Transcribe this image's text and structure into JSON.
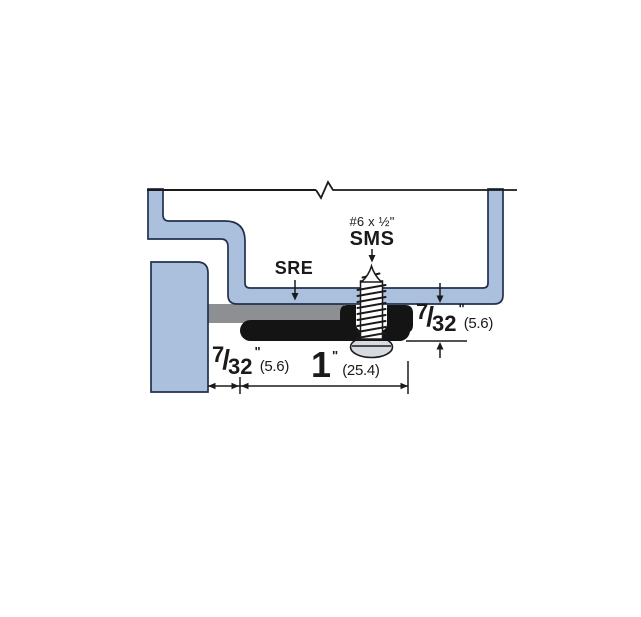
{
  "diagram": {
    "description": "Cross-section installation drawing of SRE door bottom seal fastened with sheet metal screw",
    "labels": {
      "seal": "SRE",
      "screw_size": "#6 x ½\"",
      "screw_type": "SMS"
    },
    "dimensions": {
      "seal_projection": {
        "num": "7",
        "slash": "/",
        "den": "32",
        "unit": "\"",
        "metric": "(5.6)"
      },
      "edge_gap": {
        "num": "7",
        "slash": "/",
        "den": "32",
        "unit": "\"",
        "metric": "(5.6)"
      },
      "seal_width": {
        "value": "1",
        "unit": "\"",
        "metric": "(25.4)"
      }
    },
    "colors": {
      "frame_fill": "#abc0dc",
      "frame_outline": "#22304e",
      "retainer_gray": "#8e8f92",
      "seal_black": "#141414",
      "screw_head_fill": "#d7dbe0",
      "line_dark": "#1a1a1a",
      "break_line_gray": "#85868a"
    }
  }
}
